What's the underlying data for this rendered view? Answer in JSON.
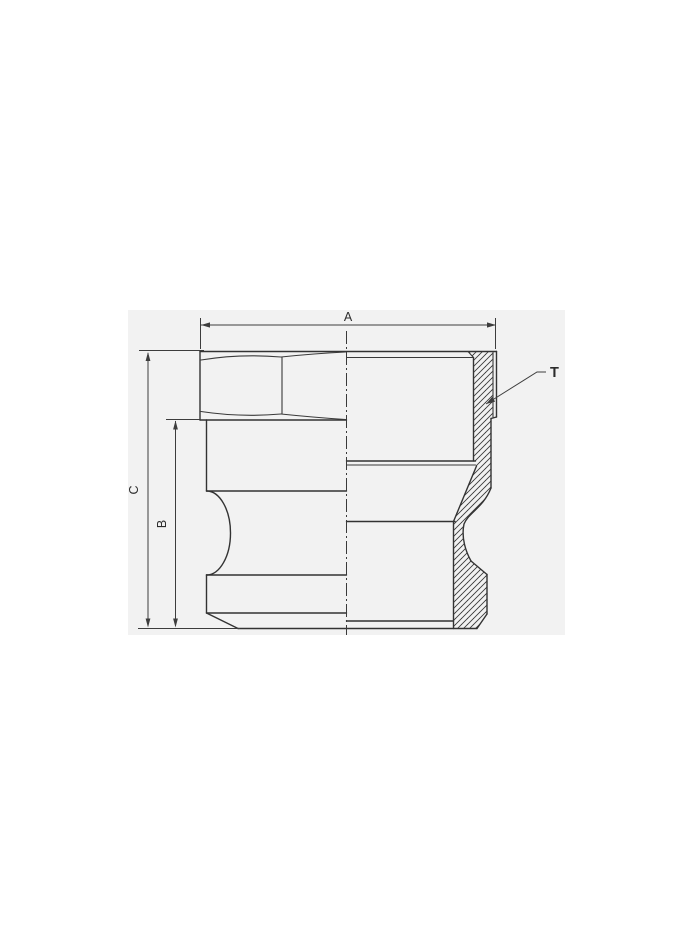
{
  "drawing": {
    "labels": {
      "dim_a": "A",
      "dim_b": "B",
      "dim_c": "C",
      "thread": "T"
    },
    "colors": {
      "page_background": "#ffffff",
      "panel_background": "#f2f2f2",
      "line": "#333333",
      "dimension_line": "#3d3d3d",
      "text": "#2b2b2b"
    }
  }
}
